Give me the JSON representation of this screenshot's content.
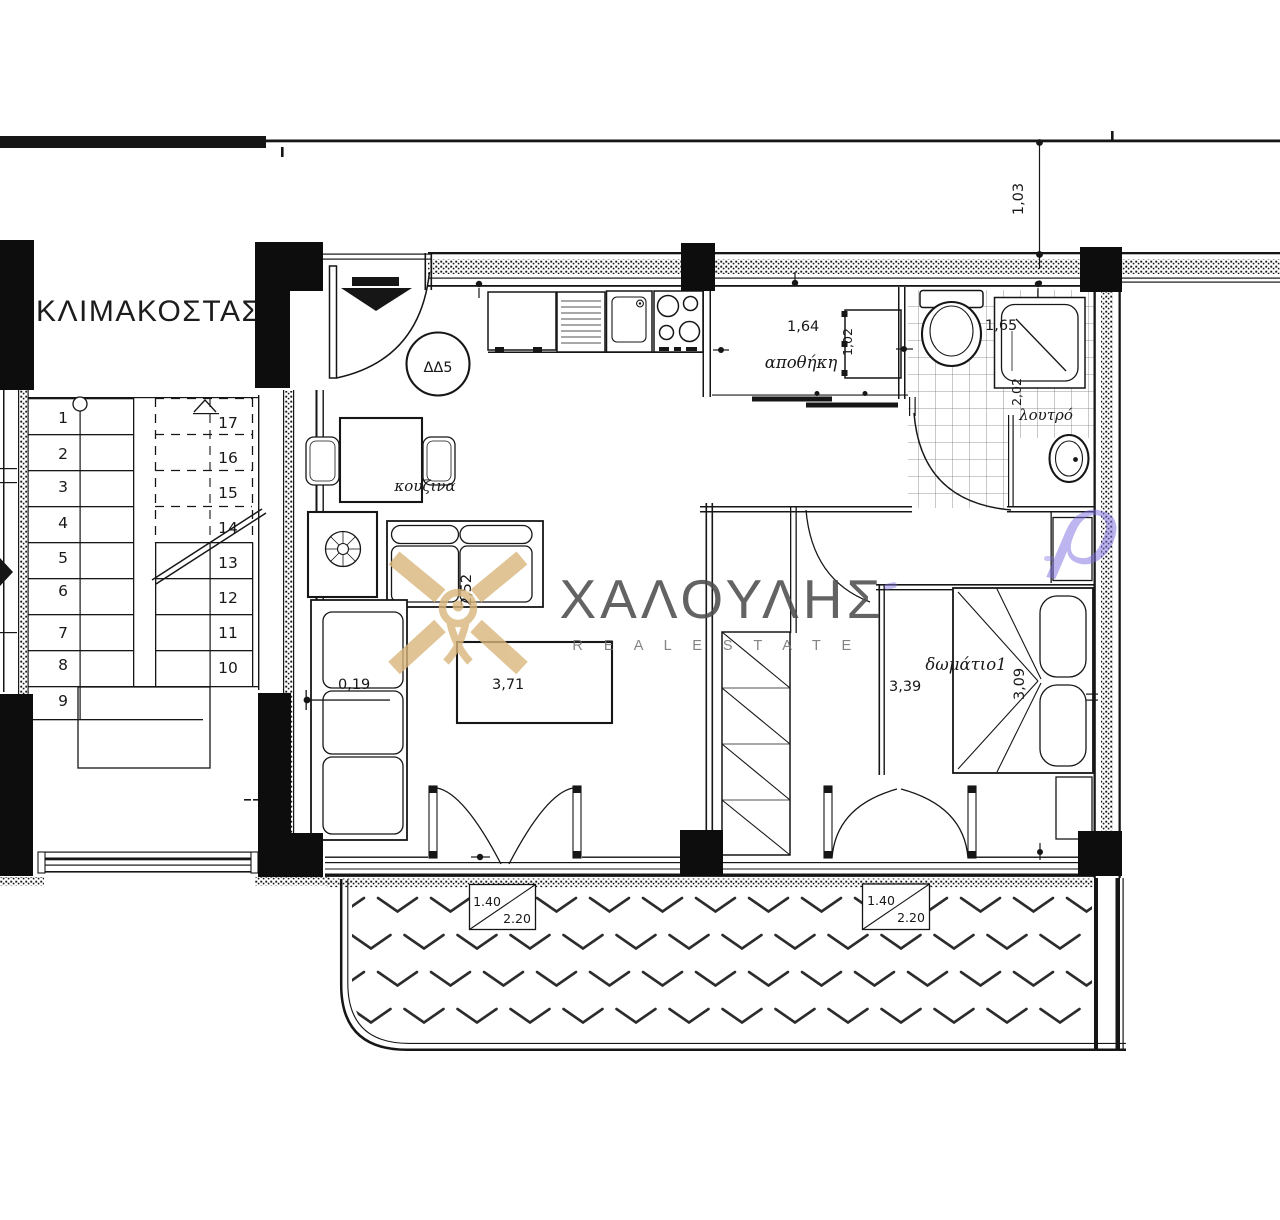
{
  "plan": {
    "stairwell_label": "ΚΛΙΜΑΚΟΣΤΑΣ",
    "unit_badge": "ΔΔ5",
    "rooms": {
      "kitchen": "κουζινα",
      "storage": "αποθήκη",
      "bathroom": "λουτρό",
      "bedroom": "δωμάτιο1"
    },
    "stairs": {
      "numbers": [
        "1",
        "2",
        "3",
        "4",
        "5",
        "6",
        "7",
        "8",
        "9",
        "10",
        "11",
        "12",
        "13",
        "14",
        "15",
        "16",
        "17"
      ]
    },
    "dimensions": {
      "storage_width": "1,64",
      "storage_door": "1,02",
      "bathroom_width": "1,65",
      "bathroom_depth": "2,02",
      "offset_top": "1,03",
      "sofa_offset": "0,19",
      "living_width": "3,71",
      "living_depth": "2,52",
      "bedroom_width": "3,39",
      "bedroom_depth": "3,09"
    },
    "windows": {
      "living": {
        "width": "1.40",
        "height": "2.20"
      },
      "bedroom": {
        "width": "1.40",
        "height": "2.20"
      }
    }
  },
  "watermark": {
    "name": "ΧΑΛΟΥΛΗΣ",
    "tagline": "R E A L   E S T A T E",
    "logo": "halkoulis-x-pin-logo",
    "stray_letter": "ρ"
  },
  "colors": {
    "line": "#161616",
    "wall_fill": "#0d0d0d",
    "brand_gold": "#d9b67c",
    "brand_gray": "#4c4c4c",
    "accent_purple": "#7c6ee1"
  }
}
